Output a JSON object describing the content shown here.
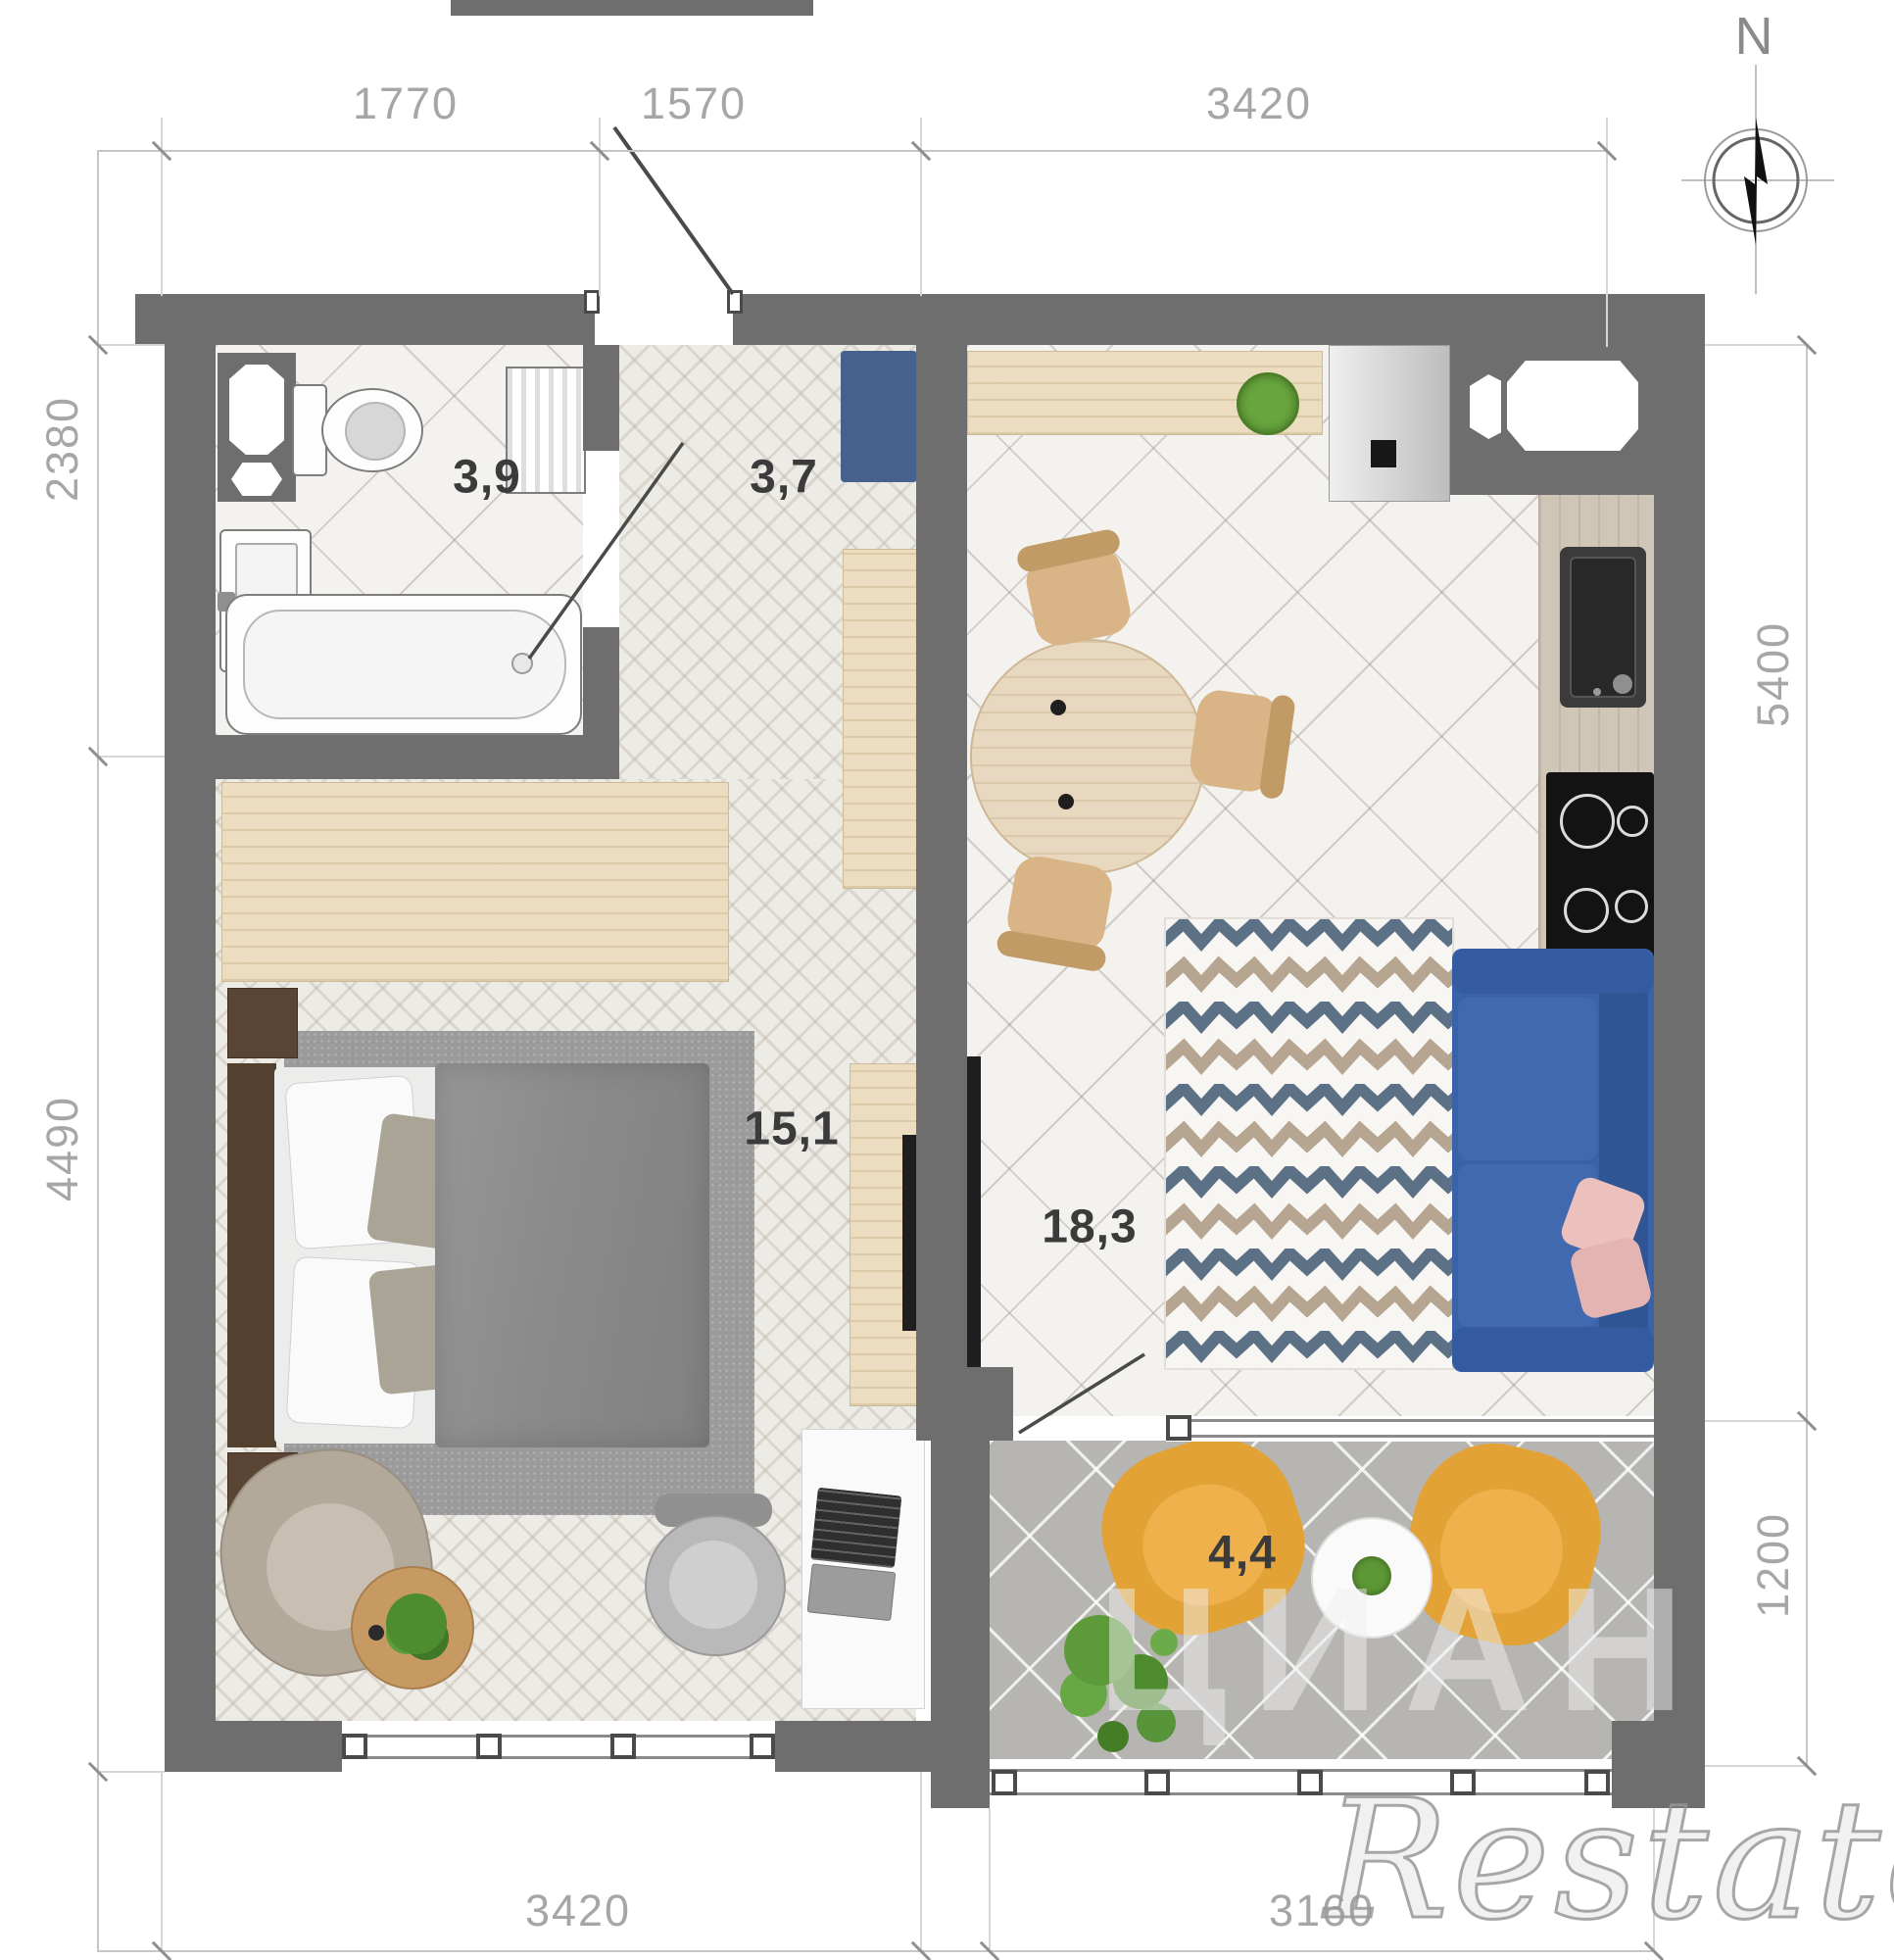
{
  "compass": {
    "label": "N"
  },
  "dimensions": {
    "top": [
      {
        "value": "1770"
      },
      {
        "value": "1570"
      },
      {
        "value": "3420"
      }
    ],
    "left": [
      {
        "value": "2380"
      },
      {
        "value": "4490"
      }
    ],
    "right": [
      {
        "value": "5400"
      },
      {
        "value": "1200"
      }
    ],
    "bottom": [
      {
        "value": "3420"
      },
      {
        "value": "3160"
      }
    ]
  },
  "rooms": {
    "bathroom": {
      "name": "bathroom",
      "area": "3,9"
    },
    "hallway": {
      "name": "hallway",
      "area": "3,7"
    },
    "bedroom": {
      "name": "bedroom",
      "area": "15,1"
    },
    "living": {
      "name": "living-kitchen",
      "area": "18,3"
    },
    "balcony": {
      "name": "balcony",
      "area": "4,4"
    }
  },
  "watermarks": {
    "portal": "ЦИАН",
    "agency": "Restate"
  },
  "colors": {
    "wall": "#6e6e6e",
    "sofa_blue": "#3a62a8",
    "armchair_yellow": "#e8a33d",
    "rug_zigzag_blue": "#5d7186",
    "rug_zigzag_tan": "#b6a691",
    "cabinet_blue": "#47618e",
    "wood_light": "#ecddc0"
  }
}
